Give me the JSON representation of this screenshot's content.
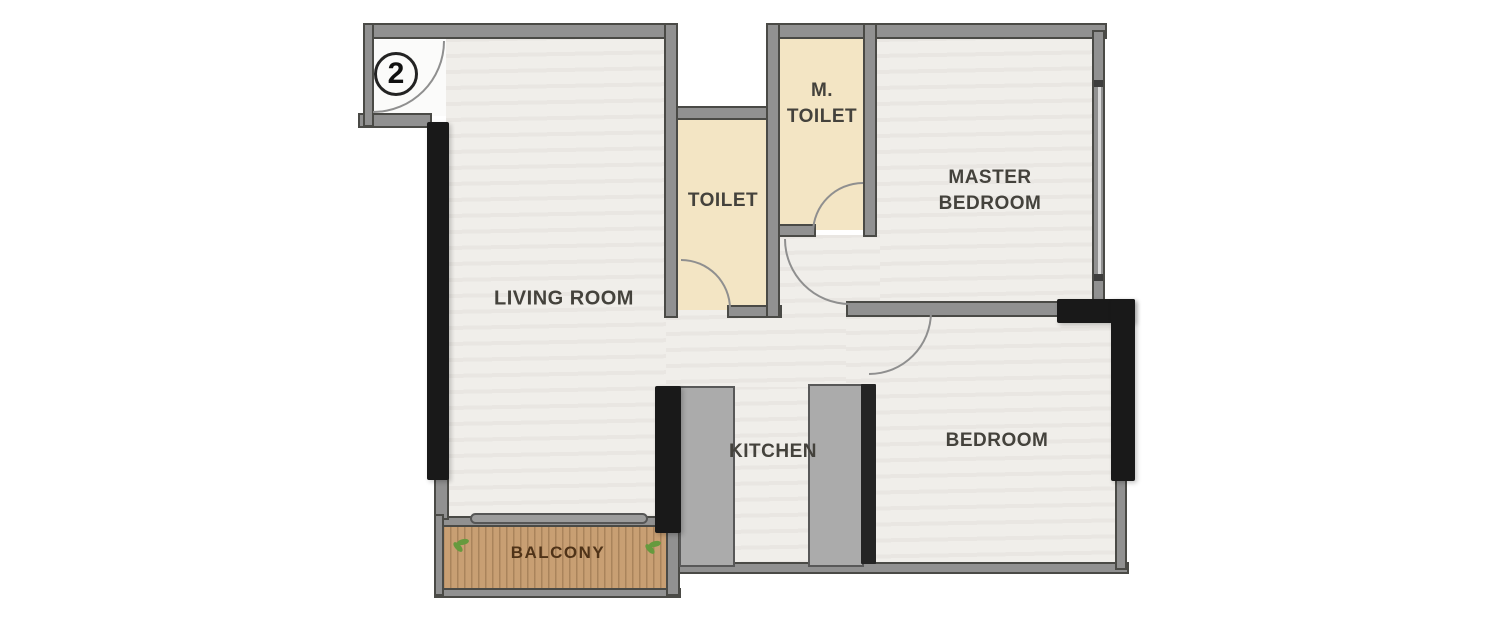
{
  "unit": {
    "number": "2"
  },
  "rooms": {
    "living_room": {
      "label": "LIVING ROOM"
    },
    "toilet": {
      "label": "TOILET"
    },
    "m_toilet": {
      "label_line1": "M.",
      "label_line2": "TOILET"
    },
    "master_bedroom": {
      "label_line1": "MASTER",
      "label_line2": "BEDROOM"
    },
    "bedroom": {
      "label": "BEDROOM"
    },
    "kitchen": {
      "label": "KITCHEN"
    },
    "balcony": {
      "label": "BALCONY"
    }
  },
  "colors": {
    "page_bg": "#ffffff",
    "wall_fill": "#919191",
    "wall_edge": "#4a4a46",
    "window_black": "#191919",
    "floor_light": "#f0eeea",
    "floor_white": "#fbfbfa",
    "toilet_floor": "#f3e5c4",
    "balcony_wood": "#c89f73",
    "label_text": "#44423c",
    "balcony_text": "#4f3318",
    "plant_green": "#669a3e",
    "door_arc": "#8f8f8f",
    "glass_line": "#d9d9d9"
  }
}
